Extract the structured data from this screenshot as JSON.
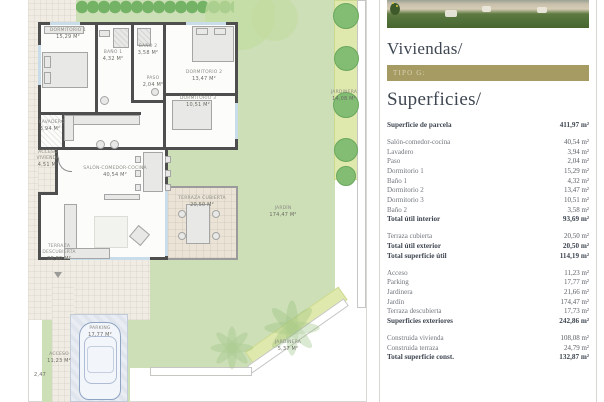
{
  "panel": {
    "title": "Viviendas/",
    "badge": "TIPO G:",
    "subtitle": "Superficies/",
    "colors": {
      "accent": "#a59b63",
      "heading": "#3e4651"
    },
    "table": {
      "rows": [
        {
          "label": "Superficie de parcela",
          "value": "411,97 m²",
          "bold": true
        },
        {
          "label": "Salón-comedor-cocina",
          "value": "40,54 m²",
          "gap": true
        },
        {
          "label": "Lavadero",
          "value": "3,94 m²"
        },
        {
          "label": "Paso",
          "value": "2,04 m²"
        },
        {
          "label": "Dormitorio 1",
          "value": "15,29 m²"
        },
        {
          "label": "Baño 1",
          "value": "4,32 m²"
        },
        {
          "label": "Dormitorio 2",
          "value": "13,47 m²"
        },
        {
          "label": "Dormitorio 3",
          "value": "10,51 m²"
        },
        {
          "label": "Baño 2",
          "value": "3,58 m²"
        },
        {
          "label": "Total útil interior",
          "value": "93,69 m²",
          "bold": true
        },
        {
          "label": "Terraza cubierta",
          "value": "20,50 m²",
          "gap": true
        },
        {
          "label": "Total útil exterior",
          "value": "20,50 m²",
          "bold": true
        },
        {
          "label": "Total superficie útil",
          "value": "114,19 m²",
          "bold": true
        },
        {
          "label": "Acceso",
          "value": "11,23 m²",
          "gap": true
        },
        {
          "label": "Parking",
          "value": "17,77 m²"
        },
        {
          "label": "Jardinera",
          "value": "21,66 m²"
        },
        {
          "label": "Jardín",
          "value": "174,47 m²"
        },
        {
          "label": "Terraza descubierta",
          "value": "17,73 m²"
        },
        {
          "label": "Superficies exteriores",
          "value": "242,86 m²",
          "bold": true
        },
        {
          "label": "Construida vivienda",
          "value": "108,08 m²",
          "gap": true
        },
        {
          "label": "Construida terraza",
          "value": "24,79 m²"
        },
        {
          "label": "Total superficie const.",
          "value": "132,87 m²",
          "bold": true
        }
      ]
    }
  },
  "plan": {
    "labels": [
      {
        "x": 44,
        "y": 28,
        "w": 48,
        "name": "Dormitorio 1",
        "area": "15,29 m²"
      },
      {
        "x": 98,
        "y": 50,
        "w": 30,
        "name": "Baño 1",
        "area": "4,32 m²"
      },
      {
        "x": 133,
        "y": 44,
        "w": 30,
        "name": "Baño 2",
        "area": "3,58 m²"
      },
      {
        "x": 176,
        "y": 70,
        "w": 56,
        "name": "Dormitorio 2",
        "area": "13,47 m²"
      },
      {
        "x": 140,
        "y": 76,
        "w": 26,
        "name": "Paso",
        "area": "2,04 m²"
      },
      {
        "x": 170,
        "y": 96,
        "w": 56,
        "name": "Dormitorio 3",
        "area": "10,51 m²"
      },
      {
        "x": 39,
        "y": 120,
        "w": 22,
        "name": "Lavadero",
        "area": "3,94 m²"
      },
      {
        "x": 82,
        "y": 166,
        "w": 66,
        "name": "Salón-comedor-cocina",
        "area": "40,54 m²"
      },
      {
        "x": 36,
        "y": 150,
        "w": 24,
        "name": "Acceso vivienda",
        "area": "4,51 m²"
      },
      {
        "x": 174,
        "y": 196,
        "w": 56,
        "name": "Terraza cubierta",
        "area": "20,50 m²"
      },
      {
        "x": 258,
        "y": 206,
        "w": 50,
        "name": "Jardín",
        "area": "174,47 m²"
      },
      {
        "x": 40,
        "y": 244,
        "w": 38,
        "name": "Terraza descubierta",
        "area": "28,80 m²"
      },
      {
        "x": 78,
        "y": 326,
        "w": 44,
        "name": "Parking",
        "area": "17,77 m²"
      },
      {
        "x": 42,
        "y": 352,
        "w": 34,
        "name": "Acceso",
        "area": "11,23 m²"
      },
      {
        "x": 330,
        "y": 90,
        "w": 28,
        "name": "Jardinera",
        "area": "14,08 m²"
      },
      {
        "x": 268,
        "y": 340,
        "w": 40,
        "name": "Jardinera",
        "area": "5,37 m²"
      },
      {
        "x": 28,
        "y": 372,
        "w": 24,
        "name": "",
        "area": "2,47"
      }
    ]
  }
}
